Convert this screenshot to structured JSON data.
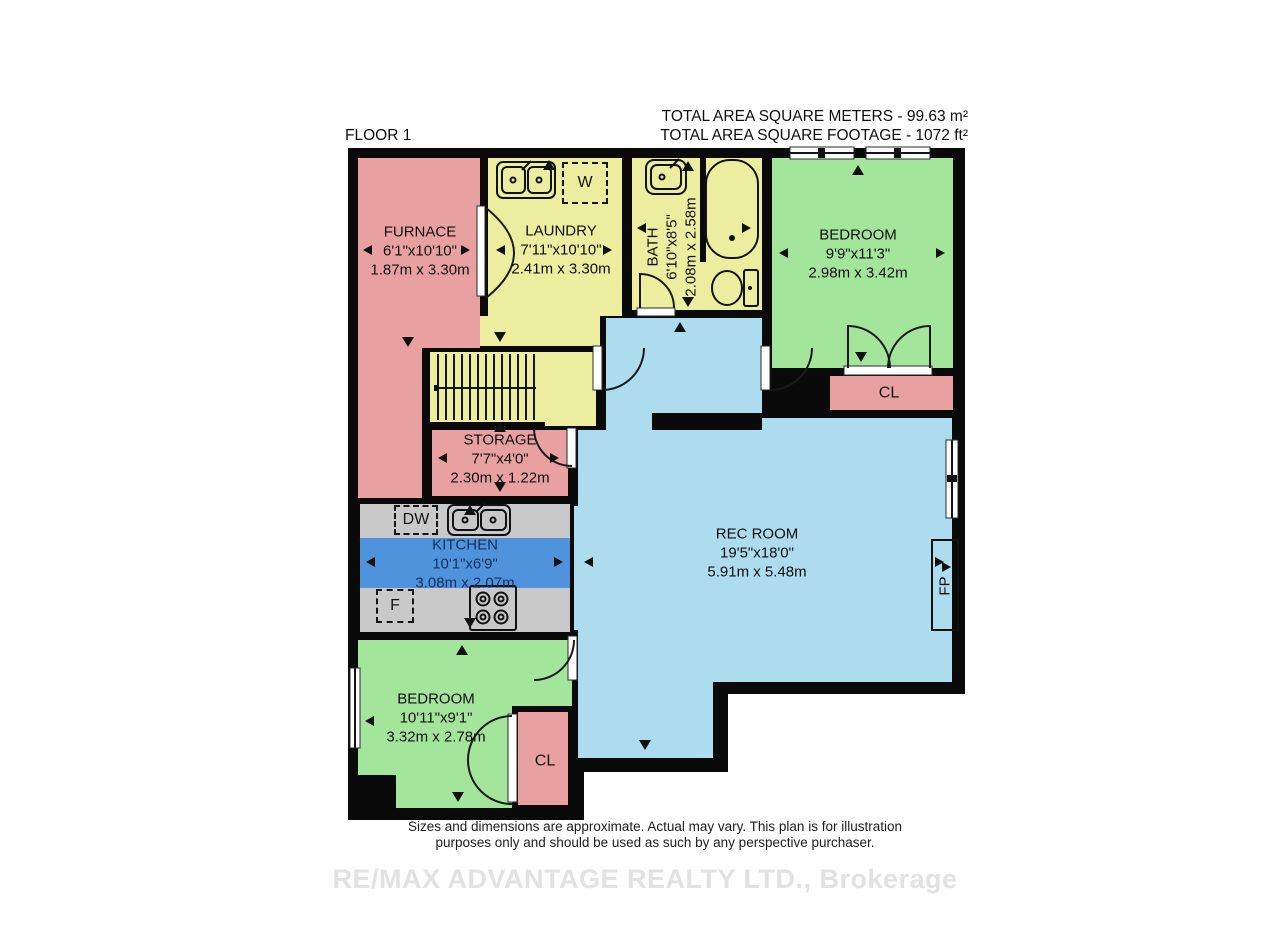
{
  "header": {
    "floor_label": "FLOOR 1",
    "area_meters": "TOTAL AREA SQUARE METERS - 99.63 m²",
    "area_feet": "TOTAL AREA SQUARE FOOTAGE - 1072 ft²"
  },
  "rooms": {
    "furnace": {
      "name": "FURNACE",
      "dims_ft": "6'1\"x10'10\"",
      "dims_m": "1.87m x 3.30m"
    },
    "laundry": {
      "name": "LAUNDRY",
      "dims_ft": "7'11\"x10'10\"",
      "dims_m": "2.41m x 3.30m"
    },
    "bath": {
      "name": "BATH",
      "dims_ft": "6'10\"x8'5\"",
      "dims_m": "2.08m x 2.58m"
    },
    "bedroom_upper": {
      "name": "BEDROOM",
      "dims_ft": "9'9\"x11'3\"",
      "dims_m": "2.98m x 3.42m"
    },
    "closet_upper": {
      "name": "CL"
    },
    "storage": {
      "name": "STORAGE",
      "dims_ft": "7'7\"x4'0\"",
      "dims_m": "2.30m x 1.22m"
    },
    "kitchen": {
      "name": "KITCHEN",
      "dims_ft": "10'1\"x6'9\"",
      "dims_m": "3.08m x 2.07m"
    },
    "rec_room": {
      "name": "REC ROOM",
      "dims_ft": "19'5\"x18'0\"",
      "dims_m": "5.91m x 5.48m"
    },
    "bedroom_lower": {
      "name": "BEDROOM",
      "dims_ft": "10'11\"x9'1\"",
      "dims_m": "3.32m x 2.78m"
    },
    "closet_lower": {
      "name": "CL"
    },
    "fireplace": {
      "name": "FP"
    }
  },
  "appliances": {
    "washer": "W",
    "dishwasher": "DW",
    "fridge": "F"
  },
  "footer": {
    "disclaimer_line1": "Sizes and dimensions are approximate. Actual may vary. This plan is for illustration",
    "disclaimer_line2": "purposes only and should be used as such by any perspective purchaser.",
    "watermark": "RE/MAX ADVANTAGE REALTY LTD., Brokerage"
  },
  "colors": {
    "wall": "#0a0a0a",
    "pink": "#e8a1a0",
    "yellow": "#ededa0",
    "green": "#a4e59c",
    "blue": "#addcee",
    "kitchen_blue": "#4f93dd",
    "counter": "#c9c9c9"
  }
}
